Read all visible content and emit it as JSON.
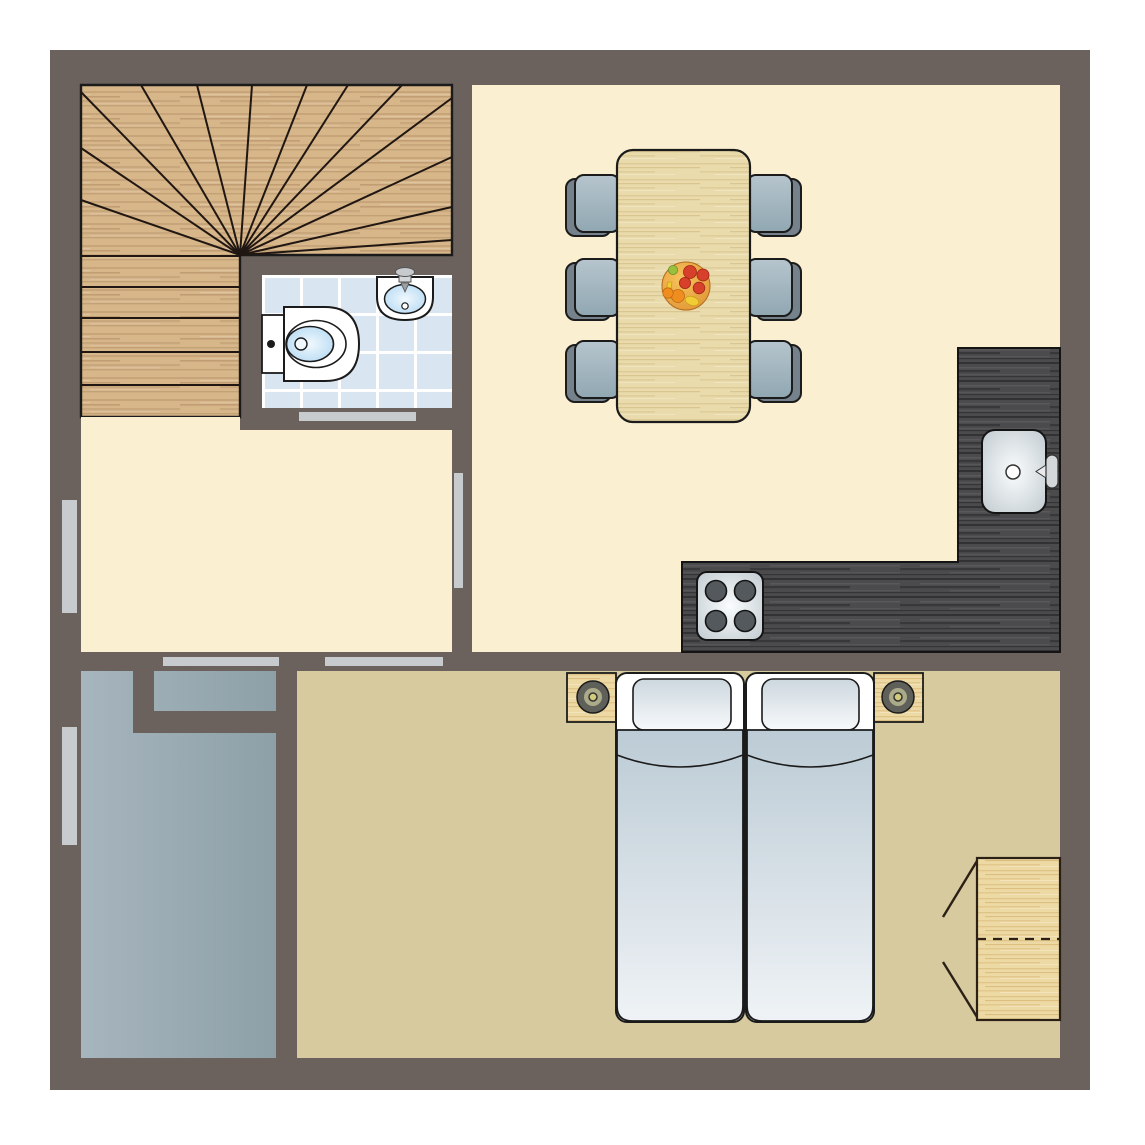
{
  "app": {
    "type": "architectural-floor-plan",
    "visible_text": []
  },
  "colors": {
    "page_bg": "#ffffff",
    "wall": "#6b625d",
    "floor_cream": "#faefd1",
    "floor_tan": "#d7ca9e",
    "terrace_light": "#a7b5be",
    "terrace_dark": "#8da0a7",
    "wood_stairs_base": "#d7b68a",
    "wood_stairs_grain": "#8b643c",
    "wood_light_base": "#e9dbac",
    "wood_light_grain": "#b08e4a",
    "cabinet_wood_base": "#edd9a4",
    "cabinet_wood_grain": "#ba8d3c",
    "counter_base": "#4b4b4d",
    "counter_grain_dark": "#141416",
    "counter_grain_light": "#828287",
    "tile": "#d9e5f0",
    "grout": "#ffffff",
    "strip": "#c8cbce",
    "outline": "#1b1b1b",
    "stair_line": "#201712",
    "chair_back": "#75828b",
    "seat_light": "#b6c5cd",
    "seat_dark": "#90a7b2",
    "duvet_top": "#bccbd5",
    "duvet_bottom": "#eff3f6",
    "pillow_top": "#ccd7de",
    "pillow_bottom": "#f7f9fb",
    "basin_center": "#f0f8fe",
    "basin_edge": "#a9d3f0",
    "glare_center": "#fafcfd",
    "glare_edge": "#b9c4ca",
    "fixture_white": "#ffffff",
    "lamp_outer": "#60605a",
    "lamp_ring": "#abab8a",
    "lamp_center": "#d2cb7e",
    "bowl_light": "#f6c35c",
    "bowl_dark": "#dd8e2e",
    "fruit_red": "#d7402b",
    "fruit_orange": "#ef8e1f",
    "fruit_yellow": "#f2cc35",
    "fruit_green": "#9abf3d",
    "burner": "#54595d",
    "faucet_metal": "#d3d7d9"
  },
  "rooms": [
    {
      "id": "staircase",
      "floor": "wood"
    },
    {
      "id": "bathroom",
      "floor": "blue-tile"
    },
    {
      "id": "hallway",
      "floor": "cream"
    },
    {
      "id": "living-dining-room",
      "floor": "cream"
    },
    {
      "id": "kitchen",
      "floor": "cream"
    },
    {
      "id": "bedroom",
      "floor": "tan"
    },
    {
      "id": "terrace",
      "floor": "gray"
    }
  ],
  "fixtures": {
    "dining_chairs": 6,
    "stove_burners": 4,
    "beds": 2,
    "pillows": 2,
    "nightstands": 2,
    "lamps": 2,
    "wardrobes": 1,
    "toilets": 1,
    "bathroom_sinks": 1,
    "kitchen_sinks": 1,
    "fruit_bowls": 1,
    "stair_winder_treads": 14,
    "stair_straight_treads": 5,
    "exterior_windows_left_wall": 2,
    "interior_door_openings": 4
  }
}
